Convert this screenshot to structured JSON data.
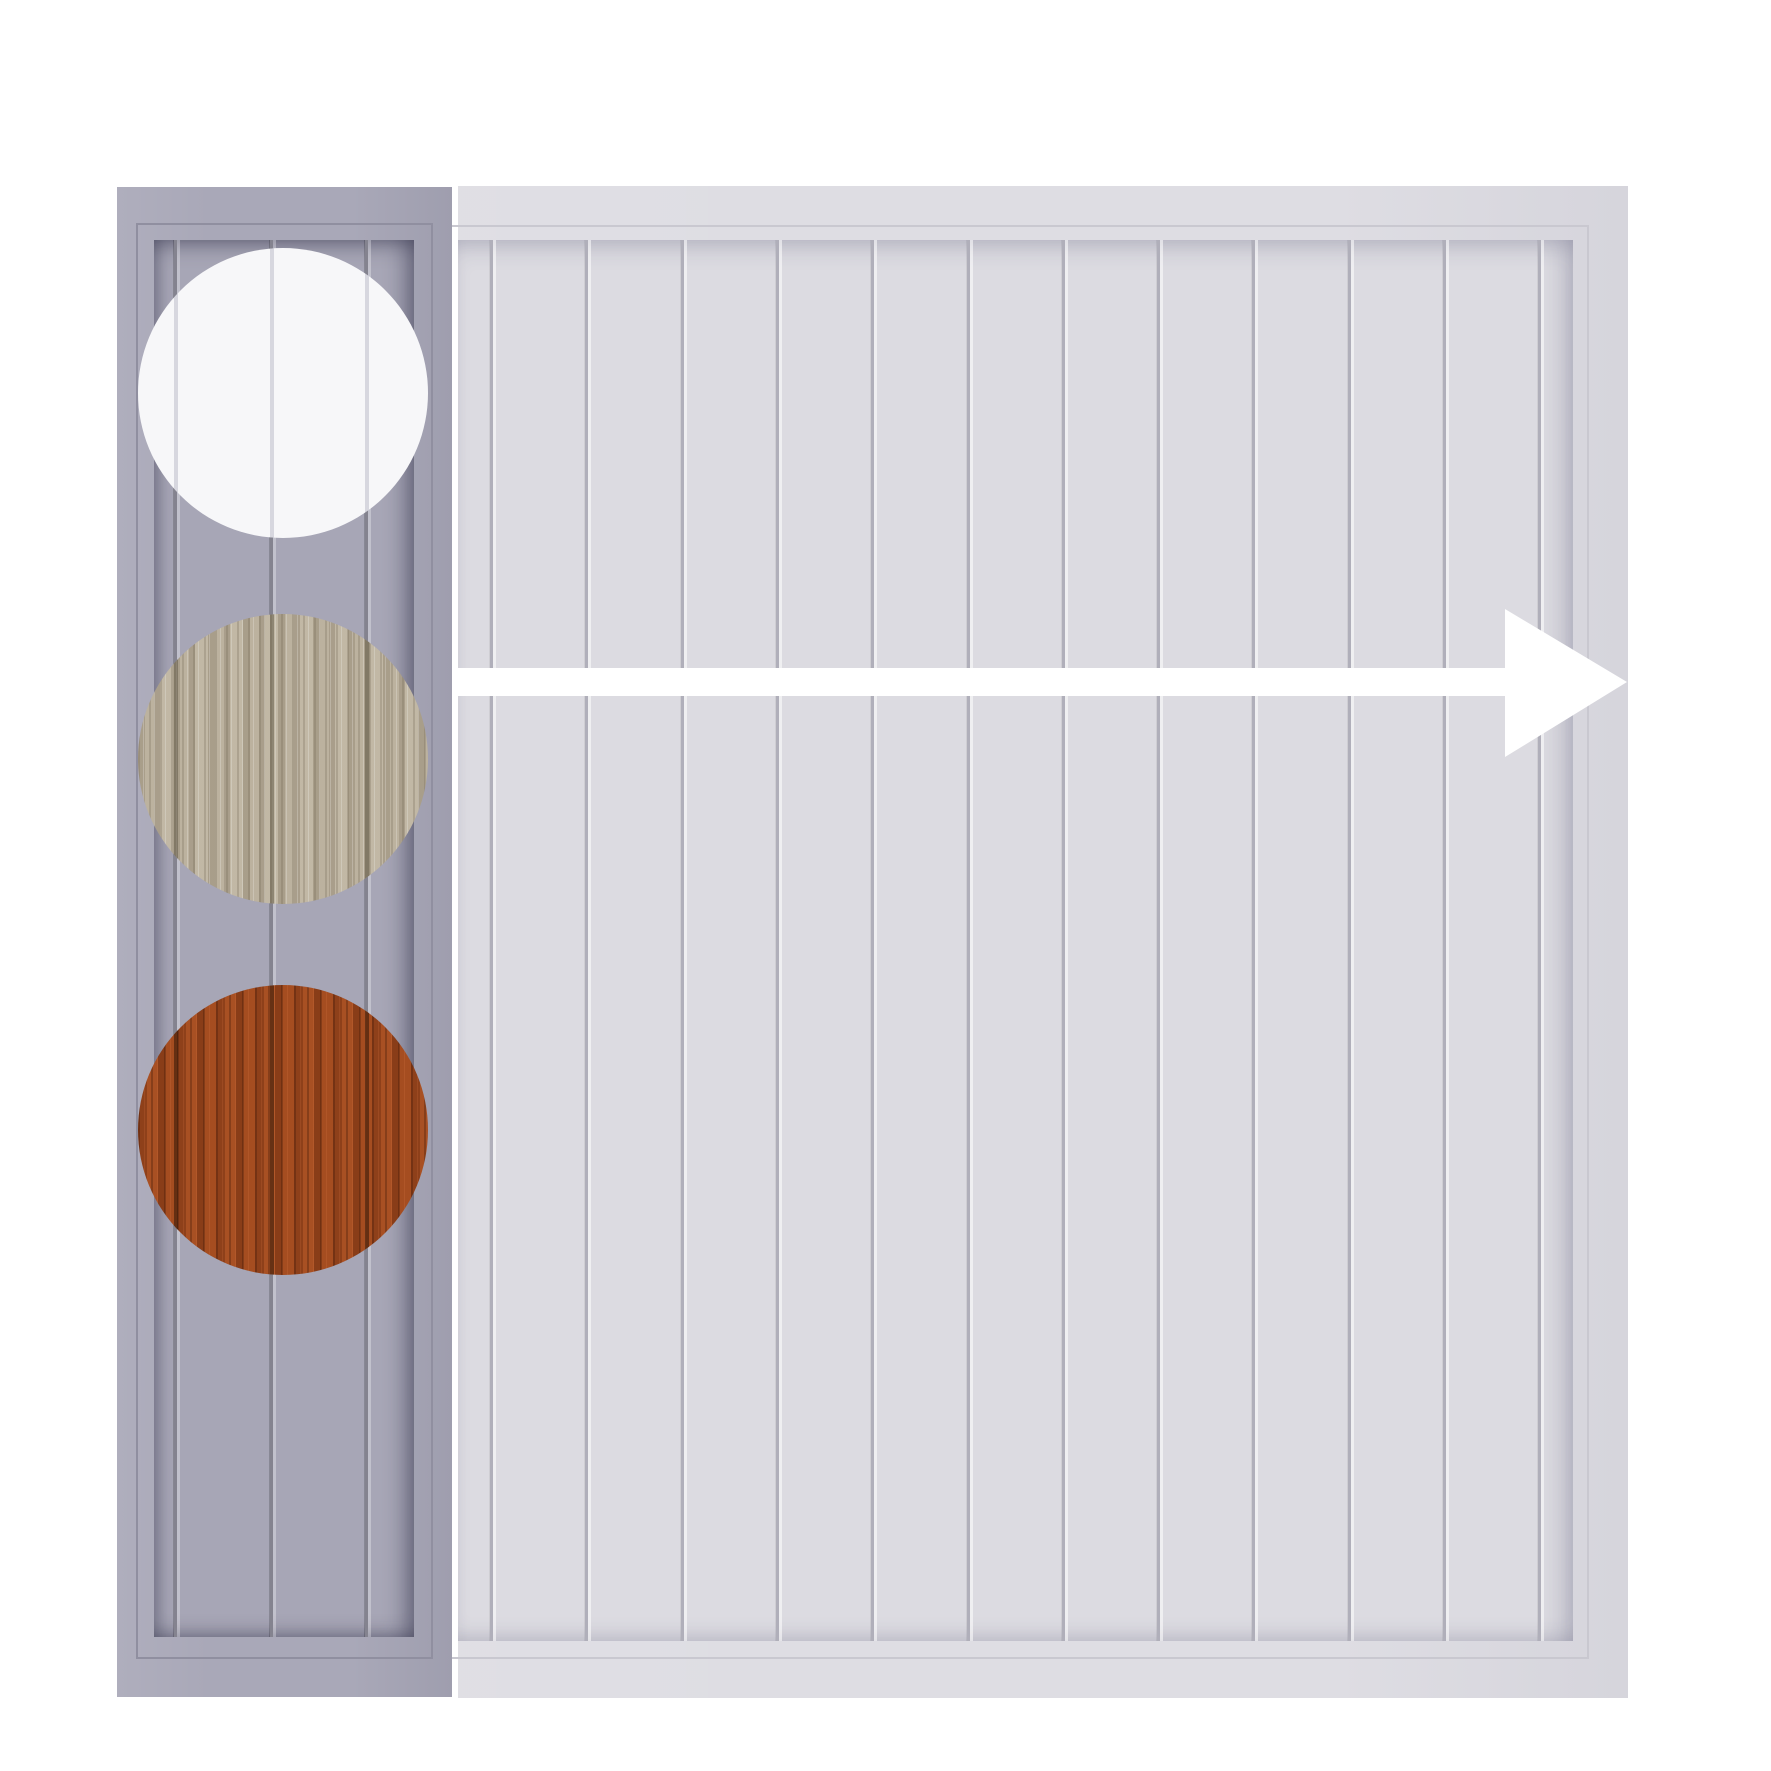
{
  "scene": {
    "title": "Fence panel finish options graphic",
    "background_color": "#ffffff"
  },
  "swatch_panel": {
    "role": "finish options column panel",
    "base_color": "#a9a8b8",
    "frame_line_color": "#908fa0",
    "board_color": "#a7a6b6",
    "groove_color": "#84838f",
    "groove_offsets_px": [
      20,
      116,
      211
    ],
    "swatches": [
      {
        "id": "white",
        "label": "White finish",
        "base_color": "#f7f7f9",
        "groove_color": "rgba(168,168,184,0.40)",
        "grain": "none"
      },
      {
        "id": "driftwood",
        "label": "Driftwood finish",
        "base_color": "#b5ab98",
        "groove_color": "rgba(92,84,66,0.50)",
        "grain": "wood-light"
      },
      {
        "id": "cherry",
        "label": "Cherry wood finish",
        "base_color": "#a04a1f",
        "groove_color": "rgba(58,28,10,0.60)",
        "grain": "wood-red"
      }
    ]
  },
  "preview_panel": {
    "role": "full panel preview",
    "base_color": "#dedde3",
    "frame_line_color": "#c9c8d0",
    "board_color": "#dcdbe1",
    "groove_color": "#b0afba",
    "first_groove_offset_px": 32,
    "board_spacing_px": 95.3,
    "groove_count": 12
  },
  "arrow": {
    "direction": "right",
    "color": "#ffffff"
  }
}
